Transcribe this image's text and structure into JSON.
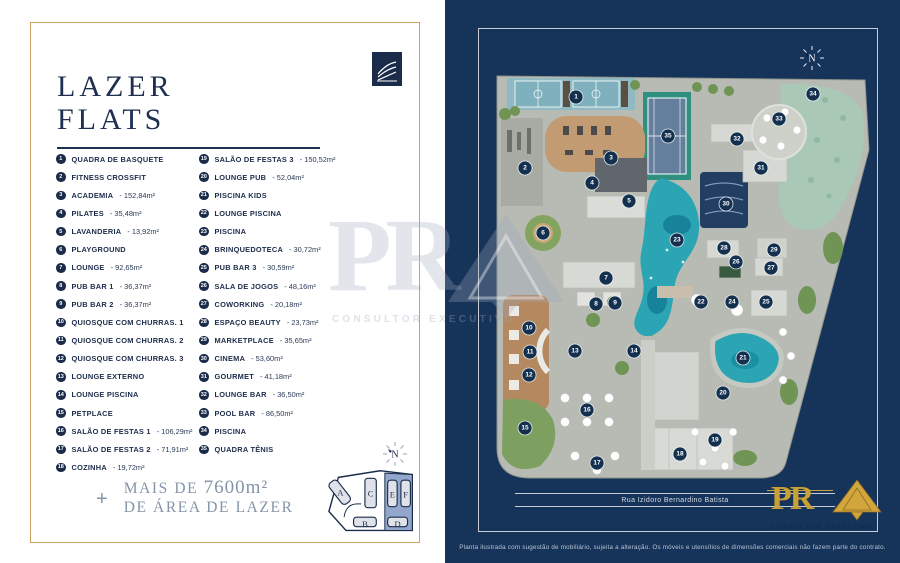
{
  "left_panel": {
    "title": {
      "line1": "LAZER",
      "line2": "FLATS"
    },
    "legend_left": [
      {
        "n": "1",
        "label": "QUADRA DE BASQUETE",
        "area": ""
      },
      {
        "n": "2",
        "label": "FITNESS CROSSFIT",
        "area": ""
      },
      {
        "n": "3",
        "label": "ACADEMIA",
        "area": "152,84m²"
      },
      {
        "n": "4",
        "label": "PILATES",
        "area": "35,48m²"
      },
      {
        "n": "5",
        "label": "LAVANDERIA",
        "area": "13,92m²"
      },
      {
        "n": "6",
        "label": "PLAYGROUND",
        "area": ""
      },
      {
        "n": "7",
        "label": "LOUNGE",
        "area": "92,65m²"
      },
      {
        "n": "8",
        "label": "PUB BAR 1",
        "area": "36,37m²"
      },
      {
        "n": "9",
        "label": "PUB BAR 2",
        "area": "36,37m²"
      },
      {
        "n": "10",
        "label": "QUIOSQUE COM CHURRAS. 1",
        "area": ""
      },
      {
        "n": "11",
        "label": "QUIOSQUE COM CHURRAS. 2",
        "area": ""
      },
      {
        "n": "12",
        "label": "QUIOSQUE COM CHURRAS. 3",
        "area": ""
      },
      {
        "n": "13",
        "label": "LOUNGE EXTERNO",
        "area": ""
      },
      {
        "n": "14",
        "label": "LOUNGE PISCINA",
        "area": ""
      },
      {
        "n": "15",
        "label": "PETPLACE",
        "area": ""
      },
      {
        "n": "16",
        "label": "SALÃO DE FESTAS 1",
        "area": "106,29m²"
      },
      {
        "n": "17",
        "label": "SALÃO DE FESTAS 2",
        "area": "71,91m²"
      },
      {
        "n": "18",
        "label": "COZINHA",
        "area": "19,72m²"
      }
    ],
    "legend_right": [
      {
        "n": "19",
        "label": "SALÃO DE FESTAS 3",
        "area": "150,52m²"
      },
      {
        "n": "20",
        "label": "LOUNGE PUB",
        "area": "52,04m²"
      },
      {
        "n": "21",
        "label": "PISCINA KIDS",
        "area": ""
      },
      {
        "n": "22",
        "label": "LOUNGE PISCINA",
        "area": ""
      },
      {
        "n": "23",
        "label": "PISCINA",
        "area": ""
      },
      {
        "n": "24",
        "label": "BRINQUEDOTECA",
        "area": "30,72m²"
      },
      {
        "n": "25",
        "label": "PUB BAR 3",
        "area": "30,59m²"
      },
      {
        "n": "26",
        "label": "SALA DE JOGOS",
        "area": "48,16m²"
      },
      {
        "n": "27",
        "label": "COWORKING",
        "area": "20,18m²"
      },
      {
        "n": "28",
        "label": "ESPAÇO BEAUTY",
        "area": "23,73m²"
      },
      {
        "n": "29",
        "label": "MARKETPLACE",
        "area": "35,65m²"
      },
      {
        "n": "30",
        "label": "CINEMA",
        "area": "53,60m²"
      },
      {
        "n": "31",
        "label": "GOURMET",
        "area": "41,18m²"
      },
      {
        "n": "32",
        "label": "LOUNGE BAR",
        "area": "36,50m²"
      },
      {
        "n": "33",
        "label": "POOL BAR",
        "area": "86,50m²"
      },
      {
        "n": "34",
        "label": "PISCINA",
        "area": ""
      },
      {
        "n": "35",
        "label": "QUADRA TÊNIS",
        "area": ""
      }
    ],
    "footer": {
      "plus": "+",
      "line1_prefix": "MAIS DE ",
      "line1_value": "7600m²",
      "line2": "DE ÁREA DE LAZER"
    },
    "compass_label": "N",
    "keyplan": {
      "blocks": [
        "A",
        "B",
        "C",
        "D",
        "E",
        "F"
      ]
    }
  },
  "right_panel": {
    "compass_label": "N",
    "street_label": "Rua Izidoro Bernardino Batista",
    "disclaimer": "Planta ilustrada com sugestão de mobiliário, sujeita a alteração. Os móveis e utensílios de dimensões comerciais não fazem parte do contrato.",
    "map_markers": [
      {
        "n": "1",
        "x": 131,
        "y": 97
      },
      {
        "n": "2",
        "x": 80,
        "y": 168
      },
      {
        "n": "3",
        "x": 166,
        "y": 158
      },
      {
        "n": "4",
        "x": 147,
        "y": 183
      },
      {
        "n": "5",
        "x": 184,
        "y": 201
      },
      {
        "n": "6",
        "x": 98,
        "y": 233
      },
      {
        "n": "7",
        "x": 161,
        "y": 278
      },
      {
        "n": "8",
        "x": 151,
        "y": 304
      },
      {
        "n": "9",
        "x": 170,
        "y": 303
      },
      {
        "n": "10",
        "x": 84,
        "y": 328
      },
      {
        "n": "11",
        "x": 85,
        "y": 352
      },
      {
        "n": "12",
        "x": 84,
        "y": 375
      },
      {
        "n": "13",
        "x": 130,
        "y": 351
      },
      {
        "n": "14",
        "x": 189,
        "y": 351
      },
      {
        "n": "15",
        "x": 80,
        "y": 428
      },
      {
        "n": "16",
        "x": 142,
        "y": 410
      },
      {
        "n": "17",
        "x": 152,
        "y": 463
      },
      {
        "n": "18",
        "x": 235,
        "y": 454
      },
      {
        "n": "19",
        "x": 270,
        "y": 440
      },
      {
        "n": "20",
        "x": 278,
        "y": 393
      },
      {
        "n": "21",
        "x": 298,
        "y": 358
      },
      {
        "n": "22",
        "x": 256,
        "y": 302
      },
      {
        "n": "23",
        "x": 232,
        "y": 240
      },
      {
        "n": "24",
        "x": 287,
        "y": 302
      },
      {
        "n": "25",
        "x": 321,
        "y": 302
      },
      {
        "n": "26",
        "x": 291,
        "y": 262
      },
      {
        "n": "27",
        "x": 326,
        "y": 268
      },
      {
        "n": "28",
        "x": 279,
        "y": 248
      },
      {
        "n": "29",
        "x": 329,
        "y": 250
      },
      {
        "n": "30",
        "x": 281,
        "y": 204
      },
      {
        "n": "31",
        "x": 316,
        "y": 168
      },
      {
        "n": "32",
        "x": 292,
        "y": 139
      },
      {
        "n": "33",
        "x": 334,
        "y": 119
      },
      {
        "n": "34",
        "x": 368,
        "y": 94
      },
      {
        "n": "35",
        "x": 223,
        "y": 136
      }
    ]
  },
  "watermark": {
    "letters": "PR",
    "subtext": "CONSULTOR EXECUTIVO"
  },
  "logo_bottom": {
    "letters": "PR",
    "subtext": "CONSULTOR EXECUTIVO"
  },
  "colors": {
    "navy_background": "#163359",
    "gold_accent": "#c8a45f",
    "text_navy": "#1c2c4a",
    "pool_teal": "#2ba4b4",
    "basket_court_blue": "#8fbac4",
    "tennis_green": "#2f9080",
    "muted_blue_text": "#8494aa",
    "marker_navy": "#14304f"
  }
}
